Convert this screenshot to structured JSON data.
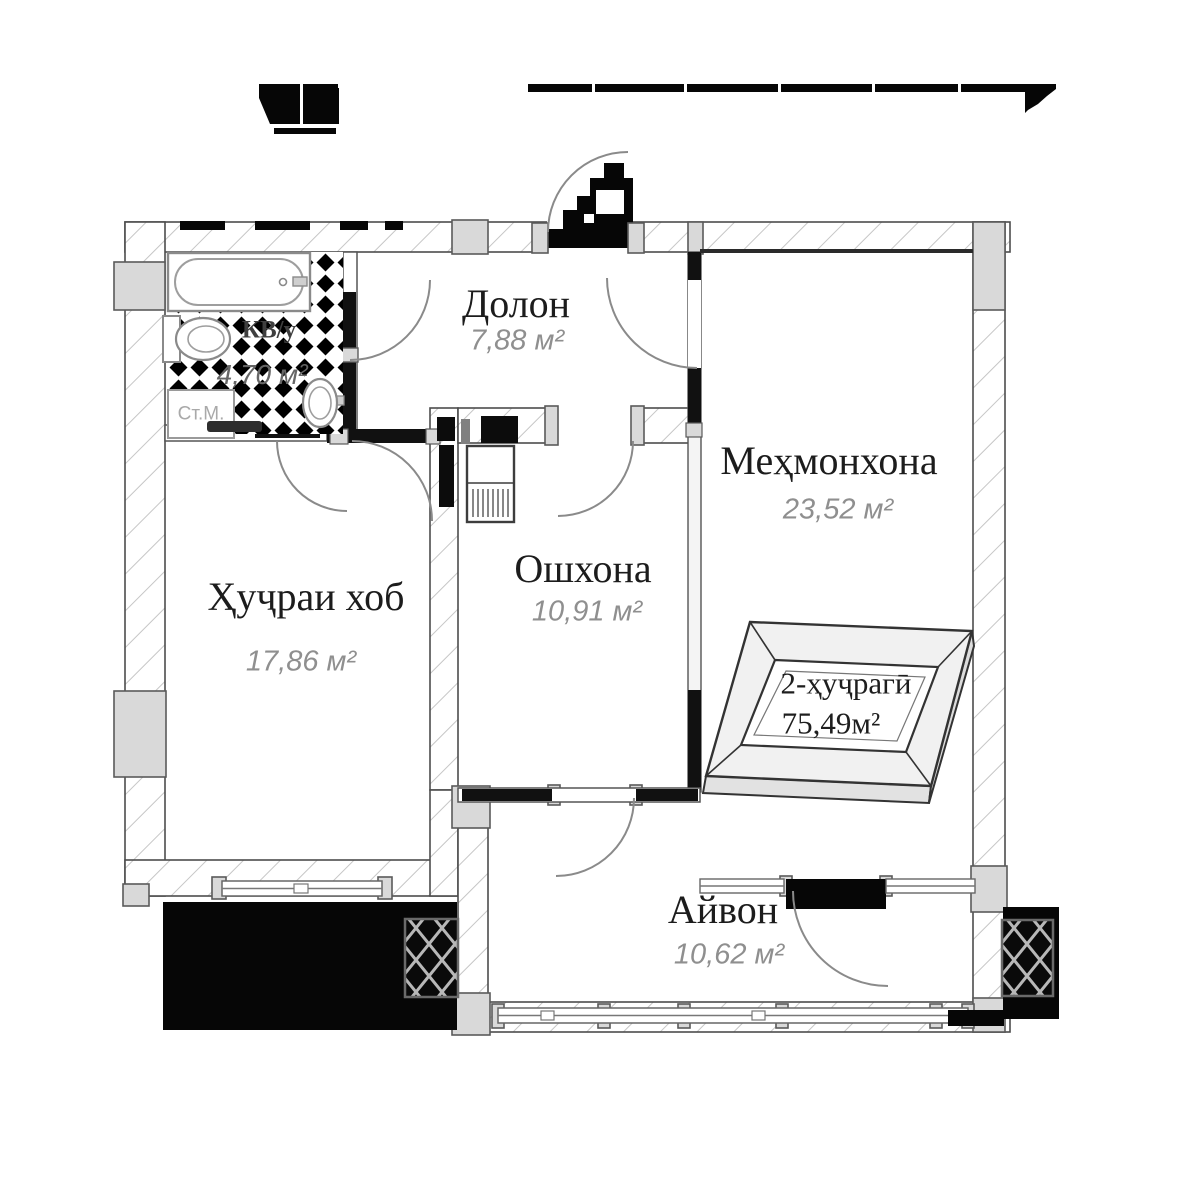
{
  "plan": {
    "rooms": [
      {
        "id": "dolon",
        "name": "Долон",
        "area": "7,88 м²"
      },
      {
        "id": "mehmonkhona",
        "name": "Меҳмонхона",
        "area": "23,52 м²"
      },
      {
        "id": "oshkhona",
        "name": "Ошхона",
        "area": "10,91 м²"
      },
      {
        "id": "hujrai-khob",
        "name": "Ҳуҷраи хоб",
        "area": "17,86 м²"
      },
      {
        "id": "ayvon",
        "name": "Айвон",
        "area": "10,62 м²"
      },
      {
        "id": "sanuzel",
        "name": "КВ/у",
        "area": "4,70 м²"
      }
    ],
    "unit_badge": {
      "type_label": "2-ҳуҷрагӣ",
      "total_area": "75,49м²"
    },
    "labels": {
      "washing_machine": "Ст.М."
    },
    "colors": {
      "wall_outline": "#4d4d4d",
      "hatch_line": "#c6c6c6",
      "pilaster_fill": "#d9d9d9",
      "black_fill": "#060606",
      "room_name_text": "#1c1c1c",
      "area_text": "#8f8f8f",
      "door_arc": "#8a8a8a"
    }
  }
}
